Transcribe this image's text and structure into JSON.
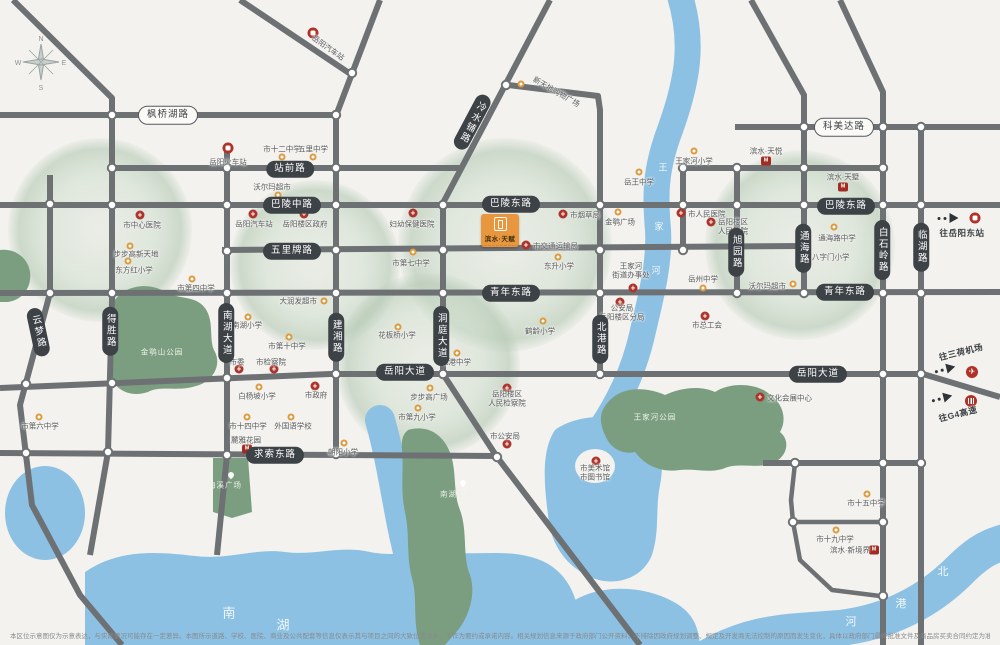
{
  "project": {
    "logo_title": "滨水·天赋",
    "logo_tagline": "——————————"
  },
  "compass": {
    "n": "N",
    "e": "E",
    "s": "S",
    "w": "W"
  },
  "map": {
    "road_labels": [
      {
        "t": "枫桥湖路",
        "x": 168,
        "y": 115,
        "light": true
      },
      {
        "t": "科美达路",
        "x": 844,
        "y": 127,
        "light": true
      },
      {
        "t": "站前路",
        "x": 290,
        "y": 169
      },
      {
        "t": "巴陵中路",
        "x": 292,
        "y": 205
      },
      {
        "t": "巴陵东路",
        "x": 511,
        "y": 204
      },
      {
        "t": "巴陵东路",
        "x": 846,
        "y": 206
      },
      {
        "t": "五里牌路",
        "x": 292,
        "y": 251
      },
      {
        "t": "青年东路",
        "x": 511,
        "y": 293
      },
      {
        "t": "青年东路",
        "x": 845,
        "y": 292
      },
      {
        "t": "岳阳大道",
        "x": 405,
        "y": 372
      },
      {
        "t": "岳阳大道",
        "x": 818,
        "y": 374
      },
      {
        "t": "求索东路",
        "x": 275,
        "y": 455
      },
      {
        "t": "冷水铺路",
        "x": 472,
        "y": 122,
        "v": true,
        "rot": 28
      },
      {
        "t": "云梦路",
        "x": 38,
        "y": 332,
        "v": true,
        "rot": -12
      },
      {
        "t": "得胜路",
        "x": 110,
        "y": 331,
        "v": true
      },
      {
        "t": "南湖大道",
        "x": 226,
        "y": 333,
        "v": true
      },
      {
        "t": "建湘路",
        "x": 336,
        "y": 337,
        "v": true
      },
      {
        "t": "洞庭大道",
        "x": 441,
        "y": 336,
        "v": true
      },
      {
        "t": "北港路",
        "x": 600,
        "y": 339,
        "v": true
      },
      {
        "t": "旭园路",
        "x": 736,
        "y": 252,
        "v": true
      },
      {
        "t": "通海路",
        "x": 803,
        "y": 248,
        "v": true
      },
      {
        "t": "白石岭路",
        "x": 882,
        "y": 250,
        "v": true
      },
      {
        "t": "临湖路",
        "x": 921,
        "y": 247,
        "v": true
      }
    ],
    "pois": [
      {
        "k": "school",
        "x": 282,
        "y": 157,
        "lines": [
          "市十二中学"
        ],
        "lx": 282,
        "ly": 149,
        "a": "c"
      },
      {
        "k": "school",
        "x": 313,
        "y": 157,
        "lines": [
          "五里中学"
        ],
        "lx": 313,
        "ly": 149,
        "a": "c"
      },
      {
        "k": "train",
        "x": 228,
        "y": 148,
        "lines": [
          "岳阳火车站"
        ],
        "lx": 228,
        "ly": 162,
        "a": "c"
      },
      {
        "k": "train",
        "x": 313,
        "y": 33,
        "lines": [
          "岳阳汽车站"
        ],
        "lx": 328,
        "ly": 48,
        "a": "c",
        "rot": 35
      },
      {
        "k": "school",
        "x": 278,
        "y": 195,
        "lines": [
          "沃尔玛超市"
        ],
        "lx": 272,
        "ly": 187,
        "a": "c"
      },
      {
        "k": "gov",
        "x": 253,
        "y": 214,
        "lines": [
          "岳阳汽车站"
        ],
        "lx": 254,
        "ly": 224,
        "a": "c"
      },
      {
        "k": "gov",
        "x": 304,
        "y": 214,
        "lines": [
          "岳阳楼区政府"
        ],
        "lx": 305,
        "ly": 224,
        "a": "c"
      },
      {
        "k": "gov",
        "x": 140,
        "y": 215,
        "lines": [
          "市中心医院"
        ],
        "lx": 142,
        "ly": 225,
        "a": "c"
      },
      {
        "k": "school",
        "x": 130,
        "y": 246,
        "lines": [
          "步步高新天地"
        ],
        "lx": 136,
        "ly": 254,
        "a": "c"
      },
      {
        "k": "school",
        "x": 128,
        "y": 261,
        "lines": [
          "东方红小学"
        ],
        "lx": 134,
        "ly": 270,
        "a": "c"
      },
      {
        "k": "school",
        "x": 192,
        "y": 279,
        "lines": [
          "市第四中学"
        ],
        "lx": 196,
        "ly": 288,
        "a": "c"
      },
      {
        "k": "gov",
        "x": 413,
        "y": 213,
        "lines": [
          "妇幼保健医院"
        ],
        "lx": 412,
        "ly": 224,
        "a": "c"
      },
      {
        "k": "school",
        "x": 413,
        "y": 252,
        "lines": [
          "市第七中学"
        ],
        "lx": 411,
        "ly": 263,
        "a": "c"
      },
      {
        "k": "gov",
        "x": 563,
        "y": 214,
        "lines": [
          "市烟草局"
        ],
        "lx": 570,
        "ly": 215,
        "a": "l"
      },
      {
        "k": "gov",
        "x": 526,
        "y": 245,
        "lines": [
          "市交通运输局"
        ],
        "lx": 533,
        "ly": 246,
        "a": "l"
      },
      {
        "k": "school",
        "x": 558,
        "y": 257,
        "lines": [
          "东升小学"
        ],
        "lx": 559,
        "ly": 266,
        "a": "c"
      },
      {
        "k": "school",
        "x": 618,
        "y": 212,
        "lines": [
          "金鹗广场"
        ],
        "lx": 620,
        "ly": 222,
        "a": "c"
      },
      {
        "k": "school",
        "x": 639,
        "y": 172,
        "lines": [
          "岳王中学"
        ],
        "lx": 639,
        "ly": 182,
        "a": "c"
      },
      {
        "k": "school",
        "x": 694,
        "y": 151,
        "lines": [
          "王家河小学"
        ],
        "lx": 694,
        "ly": 161,
        "a": "c"
      },
      {
        "k": "brand",
        "x": 766,
        "y": 161,
        "lines": [
          "滨水·天悦"
        ],
        "lx": 766,
        "ly": 151,
        "a": "c"
      },
      {
        "k": "brand",
        "x": 843,
        "y": 187,
        "lines": [
          "滨水·天墅"
        ],
        "lx": 843,
        "ly": 177,
        "a": "c"
      },
      {
        "k": "school",
        "x": 834,
        "y": 227,
        "lines": [
          "通海路中学"
        ],
        "lx": 837,
        "ly": 238,
        "a": "c"
      },
      {
        "k": "school",
        "x": 805,
        "y": 256,
        "lines": [
          "八字门小学"
        ],
        "lx": 812,
        "ly": 257,
        "a": "l"
      },
      {
        "k": "gov",
        "x": 681,
        "y": 213,
        "lines": [
          "市人民医院"
        ],
        "lx": 688,
        "ly": 214,
        "a": "l"
      },
      {
        "k": "gov",
        "x": 711,
        "y": 222,
        "lines": [
          "岳阳楼区",
          "人民法院"
        ],
        "lx": 718,
        "ly": 227,
        "a": "l"
      },
      {
        "k": "gov",
        "x": 633,
        "y": 288,
        "lines": [
          "王家河",
          "街道办事处"
        ],
        "lx": 631,
        "ly": 271,
        "a": "c"
      },
      {
        "k": "school",
        "x": 703,
        "y": 288,
        "lines": [
          "岳州中学"
        ],
        "lx": 703,
        "ly": 279,
        "a": "c"
      },
      {
        "k": "school",
        "x": 793,
        "y": 284,
        "lines": [
          "沃尔玛超市"
        ],
        "lx": 786,
        "ly": 286,
        "a": "r"
      },
      {
        "k": "gov",
        "x": 705,
        "y": 316,
        "lines": [
          "市总工会"
        ],
        "lx": 707,
        "ly": 325,
        "a": "c"
      },
      {
        "k": "gov",
        "x": 620,
        "y": 302,
        "lines": [
          "公安局",
          "岳阳楼区分局"
        ],
        "lx": 622,
        "ly": 313,
        "a": "c"
      },
      {
        "k": "school",
        "x": 543,
        "y": 321,
        "lines": [
          "鹤龄小学"
        ],
        "lx": 540,
        "ly": 331,
        "a": "c"
      },
      {
        "k": "school",
        "x": 457,
        "y": 353,
        "lines": [
          "北港中学"
        ],
        "lx": 456,
        "ly": 362,
        "a": "c"
      },
      {
        "k": "school",
        "x": 248,
        "y": 317,
        "lines": [
          "南湖小学"
        ],
        "lx": 247,
        "ly": 325,
        "a": "c"
      },
      {
        "k": "school",
        "x": 289,
        "y": 337,
        "lines": [
          "市第十中学"
        ],
        "lx": 287,
        "ly": 346,
        "a": "c"
      },
      {
        "k": "school",
        "x": 324,
        "y": 301,
        "lines": [
          "大润发超市"
        ],
        "lx": 317,
        "ly": 301,
        "a": "r"
      },
      {
        "k": "school",
        "x": 398,
        "y": 327,
        "lines": [
          "花板桥小学"
        ],
        "lx": 397,
        "ly": 335,
        "a": "c"
      },
      {
        "k": "gov",
        "x": 239,
        "y": 369,
        "lines": [
          "市委"
        ],
        "lx": 237,
        "ly": 362,
        "a": "c"
      },
      {
        "k": "gov",
        "x": 274,
        "y": 369,
        "lines": [
          "市检察院"
        ],
        "lx": 271,
        "ly": 362,
        "a": "c"
      },
      {
        "k": "school",
        "x": 259,
        "y": 387,
        "lines": [
          "白杨坡小学"
        ],
        "lx": 257,
        "ly": 396,
        "a": "c"
      },
      {
        "k": "gov",
        "x": 315,
        "y": 386,
        "lines": [
          "市政府"
        ],
        "lx": 316,
        "ly": 395,
        "a": "c"
      },
      {
        "k": "school",
        "x": 247,
        "y": 417,
        "lines": [
          "市十四中学"
        ],
        "lx": 248,
        "ly": 426,
        "a": "c"
      },
      {
        "k": "school",
        "x": 291,
        "y": 417,
        "lines": [
          "外国语学校"
        ],
        "lx": 293,
        "ly": 426,
        "a": "c"
      },
      {
        "k": "school",
        "x": 344,
        "y": 443,
        "lines": [
          "朝阳小学"
        ],
        "lx": 343,
        "ly": 452,
        "a": "c"
      },
      {
        "k": "school",
        "x": 418,
        "y": 408,
        "lines": [
          "市第九小学"
        ],
        "lx": 417,
        "ly": 417,
        "a": "c"
      },
      {
        "k": "school",
        "x": 430,
        "y": 388,
        "lines": [
          "步步高广场"
        ],
        "lx": 429,
        "ly": 397,
        "a": "c"
      },
      {
        "k": "gov",
        "x": 507,
        "y": 388,
        "lines": [
          "岳阳楼区",
          "人民检察院"
        ],
        "lx": 507,
        "ly": 399,
        "a": "c"
      },
      {
        "k": "gov",
        "x": 507,
        "y": 444,
        "lines": [
          "市公安局"
        ],
        "lx": 505,
        "ly": 436,
        "a": "c"
      },
      {
        "k": "school",
        "x": 39,
        "y": 417,
        "lines": [
          "市第六中学"
        ],
        "lx": 40,
        "ly": 426,
        "a": "c"
      },
      {
        "k": "gov",
        "x": 596,
        "y": 461,
        "lines": [
          "市美术馆",
          "市图书馆"
        ],
        "lx": 595,
        "ly": 473,
        "a": "c"
      },
      {
        "k": "gov",
        "x": 760,
        "y": 397,
        "lines": [
          "文化会展中心"
        ],
        "lx": 767,
        "ly": 398,
        "a": "l"
      },
      {
        "k": "school",
        "x": 867,
        "y": 494,
        "lines": [
          "市十五中学"
        ],
        "lx": 866,
        "ly": 503,
        "a": "c"
      },
      {
        "k": "school",
        "x": 836,
        "y": 530,
        "lines": [
          "市十九中学"
        ],
        "lx": 835,
        "ly": 539,
        "a": "c"
      },
      {
        "k": "brand",
        "x": 874,
        "y": 550,
        "lines": [
          "滨水·新境界"
        ],
        "lx": 870,
        "ly": 550,
        "a": "r"
      },
      {
        "k": "brand",
        "x": 247,
        "y": 449,
        "lines": [
          "麓雅花园"
        ],
        "lx": 246,
        "ly": 440,
        "a": "c"
      },
      {
        "k": "school",
        "x": 521,
        "y": 84,
        "lines": [
          "新天地购物广场"
        ],
        "lx": 530,
        "ly": 92,
        "a": "l",
        "rot": 30
      }
    ],
    "parks": [
      {
        "label": "金鹗山公园",
        "x": 162,
        "y": 352
      },
      {
        "label": "王家河公园",
        "x": 655,
        "y": 417
      },
      {
        "label": "梅溪广场",
        "x": 225,
        "y": 485,
        "dx": 228,
        "dy": 472
      },
      {
        "label": "南湖公园",
        "x": 457,
        "y": 494,
        "dx": 460,
        "dy": 480
      }
    ],
    "water_labels": [
      {
        "ch": "王",
        "x": 663,
        "y": 167,
        "s": 9
      },
      {
        "ch": "家",
        "x": 659,
        "y": 226,
        "s": 9
      },
      {
        "ch": "河",
        "x": 656,
        "y": 270,
        "s": 9
      },
      {
        "ch": "南",
        "x": 229,
        "y": 612,
        "s": 13
      },
      {
        "ch": "湖",
        "x": 283,
        "y": 624,
        "s": 13
      },
      {
        "ch": "北",
        "x": 943,
        "y": 571,
        "s": 11
      },
      {
        "ch": "港",
        "x": 901,
        "y": 603,
        "s": 11
      },
      {
        "ch": "河",
        "x": 851,
        "y": 621,
        "s": 11
      }
    ],
    "directions": [
      {
        "label": "往岳阳东站",
        "icon": "train",
        "ax": 948,
        "ay": 218,
        "ix": 975,
        "iy": 218,
        "lx": 962,
        "ly": 233,
        "rot": 0
      },
      {
        "label": "往三荷机场",
        "icon": "plane",
        "ax": 945,
        "ay": 369,
        "ix": 972,
        "iy": 372,
        "lx": 961,
        "ly": 352,
        "rot": -14
      },
      {
        "label": "往G4高速",
        "icon": "hw",
        "ax": 942,
        "ay": 398,
        "ix": 971,
        "iy": 401,
        "lx": 958,
        "ly": 414,
        "rot": -14
      }
    ],
    "disclaimer": "本区位示意图仅为示意表达，与实际情况可能存在一定差异。本图所示道路、学校、医院、商业及公共配套等信息仅表示其与项目之间的大致位置关系，不作为要约或承诺内容。相关规划信息来源于政府部门公开资料，不排除因政府规划调整、规定及开发商无法控制的原因而发生变化，具体以政府部门最终批准文件及商品房买卖合同约定为准。本公司保留对宣传资料修改的权利，敬请留意最新资料。"
  }
}
